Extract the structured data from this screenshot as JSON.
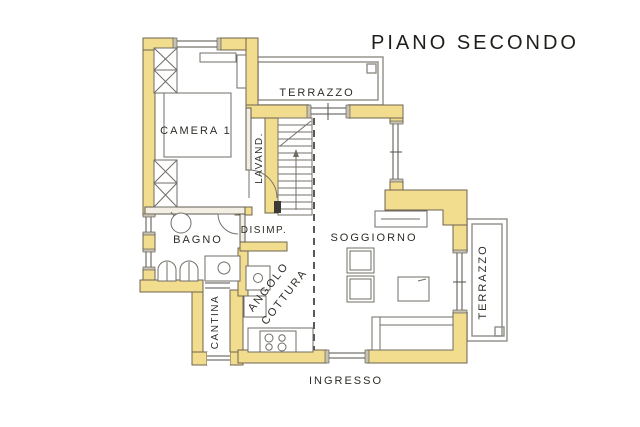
{
  "title": "PIANO SECONDO",
  "rooms": {
    "camera": {
      "label": "CAMERA 1"
    },
    "terrazzo_top": {
      "label": "TERRAZZO"
    },
    "lavanderia": {
      "label": "LAVAND."
    },
    "bagno": {
      "label": "BAGNO"
    },
    "disimpegno": {
      "label": "DISIMP."
    },
    "soggiorno": {
      "label": "SOGGIORNO"
    },
    "angolo_cottura": {
      "label_line1": "ANGOLO",
      "label_line2": "COTTURA"
    },
    "cantina": {
      "label": "CANTINA"
    },
    "terrazzo_right": {
      "label": "TERRAZZO"
    },
    "ingresso": {
      "label": "INGRESSO"
    }
  },
  "colors": {
    "wall_fill": "#f2dd8e",
    "wall_outline": "#6e6450",
    "line_dark": "#4a4741",
    "line_gray": "#8f8d85",
    "text": "#2e2c27",
    "background": "#ffffff"
  }
}
